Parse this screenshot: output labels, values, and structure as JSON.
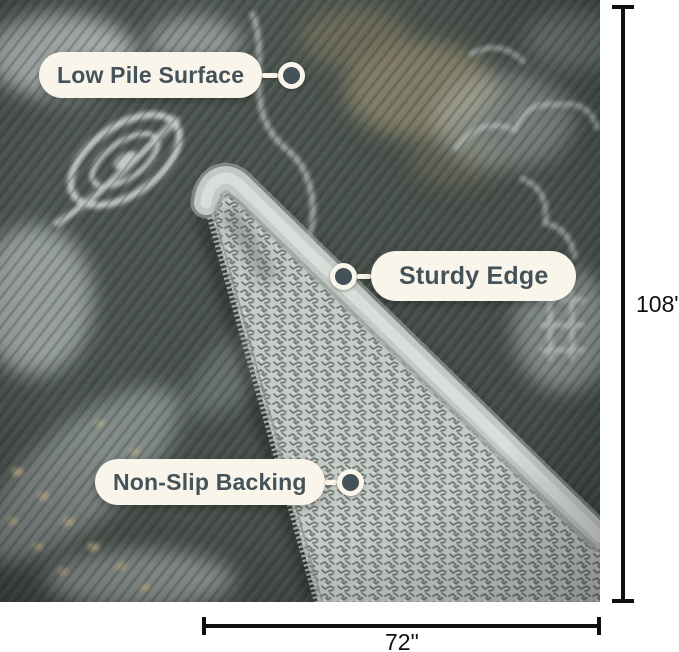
{
  "photo": {
    "alt": "Folded corner of a distressed vintage grey area rug revealing a textured woven non-slip backing and a serged binding edge"
  },
  "callouts": [
    {
      "id": "low-pile-surface",
      "label": "Low Pile Surface"
    },
    {
      "id": "sturdy-edge",
      "label": "Sturdy Edge"
    },
    {
      "id": "non-slip-backing",
      "label": "Non-Slip Backing"
    }
  ],
  "dimensions": {
    "height": "108\"",
    "width": "72\""
  },
  "colors": {
    "page_bg": "#FFFFFF",
    "pill_bg": "#F9F5EA",
    "pill_text": "#44525A",
    "connector": "#F9F5EA",
    "dot_fill": "#46525A",
    "dimension_line": "#0F0F0F",
    "rug_dark": "#434C47",
    "rug_light": "#CDD5D4",
    "rug_tan": "#8B8266",
    "backing": "#C6CCC8"
  }
}
